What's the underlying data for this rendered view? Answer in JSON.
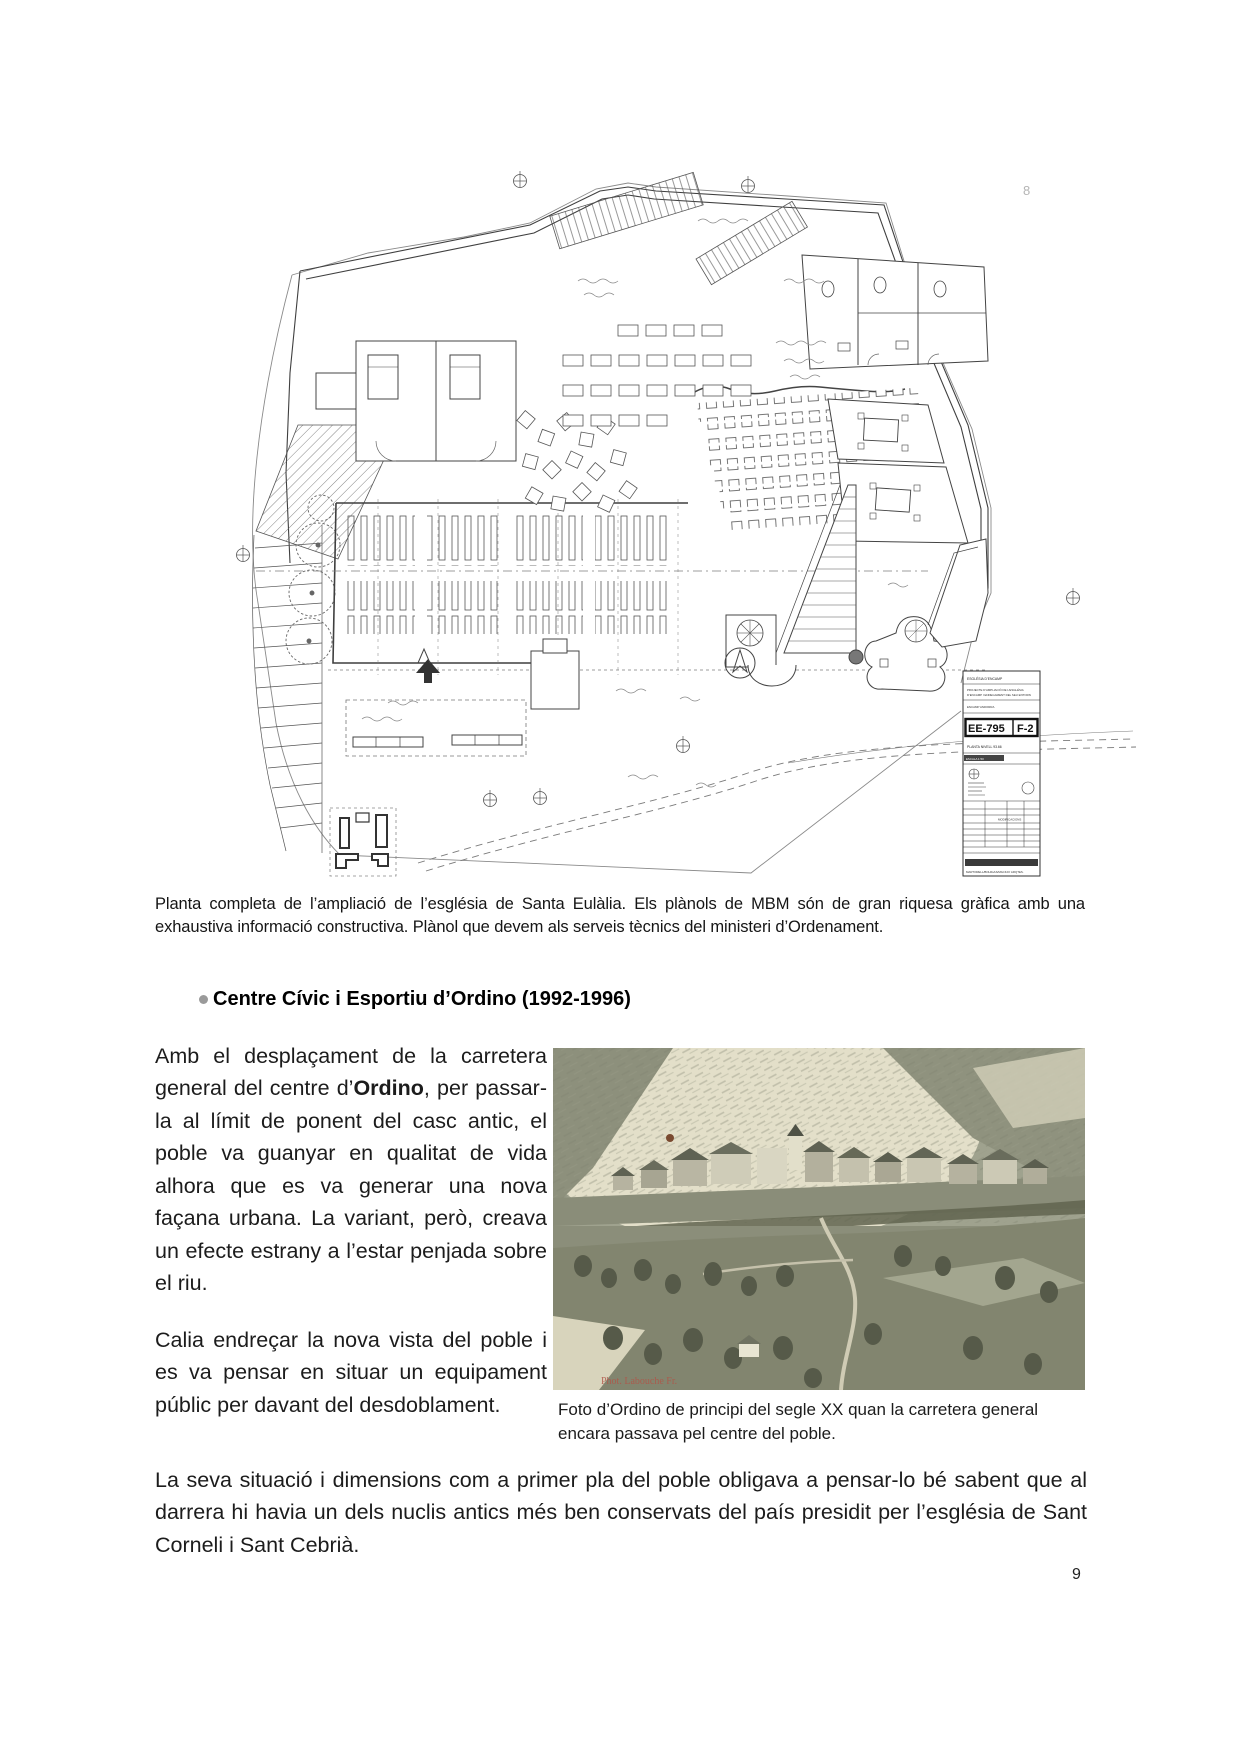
{
  "page": {
    "number": "9",
    "artifact_top_right": "8"
  },
  "plan_figure": {
    "titleblock": {
      "client": "ESGLÉSIA D’ENCAMP",
      "project_l1": "PROJECTE D’AMPLIACIÓ DE L’ESGLÉSIA",
      "project_l2": "D’ENCAMP I ENDEGAMENT DEL SEU ENTORN",
      "location": "ENCAMP   ANDORRA",
      "code": "EE-795",
      "sheet": "F-2",
      "plan_level": "PLANTA  NIVELL  93.66",
      "scale": "ESCALA  1:50",
      "modifications": "MODIFICACIONS",
      "firm": "MARTORELL/BOHIGAS/MACKAY ARQTES."
    },
    "caption": "Planta completa de l’ampliació de l’església de Santa Eulàlia. Els plànols de MBM són de gran riquesa gràfica amb una exhaustiva informació constructiva. Plànol que devem als serveis tècnics del ministeri d’Ordenament."
  },
  "section": {
    "heading": "Centre Cívic i Esportiu d’Ordino (1992-1996)"
  },
  "body": {
    "para1_before": "Amb el desplaçament de la carretera general del centre d’",
    "para1_bold": "Ordino",
    "para1_after": ", per passar-la al límit de ponent del casc antic, el poble va guanyar en qualitat de vida alhora que es va generar una nova façana urbana. La variant, però, creava un efecte estrany a l’estar penjada sobre el riu.",
    "para2": "Calia endreçar la nova vista del poble i es va pensar en situar un equipament públic per davant del desdoblament.",
    "para3": "La seva situació i dimensions com a primer pla del poble obligava a pensar-lo bé sabent que al darrera hi havia un dels nuclis antics més ben conservats del país presidit per l’església de Sant Corneli i Sant Cebrià."
  },
  "photo": {
    "caption": "Foto d’Ordino de principi del segle XX quan la carretera general encara passava pel centre del poble.",
    "credit": "Phot. Labouche Fr.",
    "palette": {
      "light": "#e2decа",
      "mid": "#8d907c",
      "dark": "#575b4a",
      "accent_red": "#b05548"
    }
  }
}
